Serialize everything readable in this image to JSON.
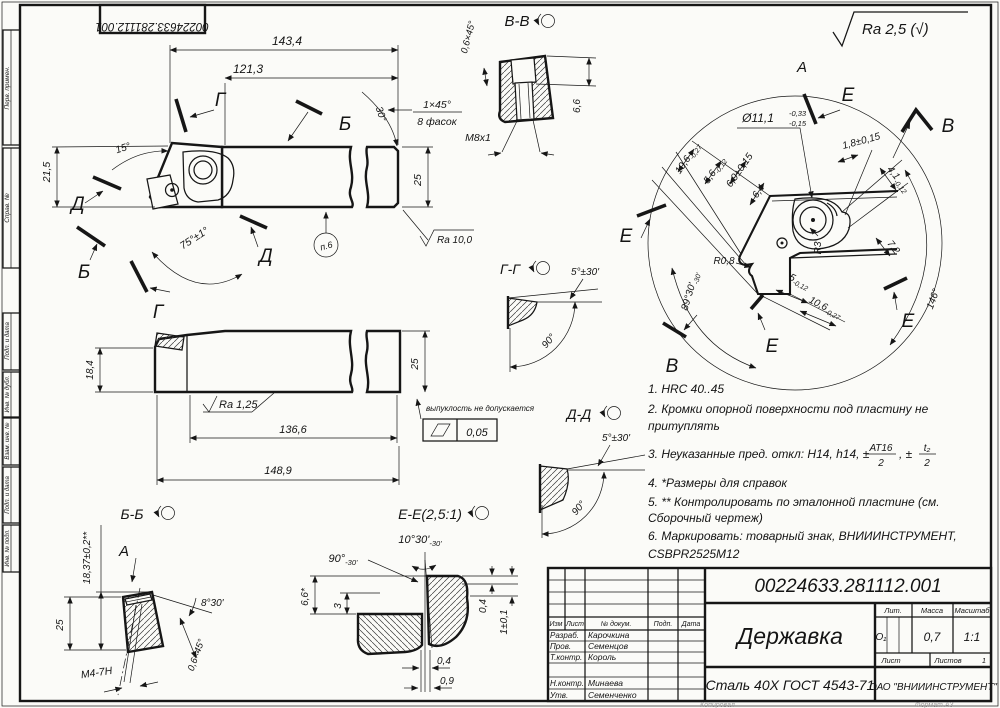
{
  "corner_stamp": "00224633.281112.001",
  "margin": [
    "Перв. примен.",
    "Справ. №",
    "Подп. и дата",
    "Инв. № дубл.",
    "Взам. инв. №",
    "Подп. и дата",
    "Инв. № подл."
  ],
  "general_roughness": "Ra 2,5 (√)",
  "top_view": {
    "label_g": "Г",
    "label_b": "Б",
    "label_d": "Д",
    "dim_total": "143,4",
    "dim_shank": "121,3",
    "angle_head": "15°",
    "dim_height_head": "21,5",
    "angle_main": "75°±1°",
    "angle_tip": "30°",
    "chamfer": "1×45°",
    "chamfer_count": "8 фасок",
    "dim_height": "25",
    "roughness": "Ra 10,0",
    "note_ref": "п.6"
  },
  "section_vv": {
    "title": "В-В",
    "chamfer": "0,6×45°",
    "depth": "6,6",
    "thread": "М8х1"
  },
  "detail_a": {
    "label": "А",
    "dia": {
      "main": "Ø11,1",
      "up": "-0,33",
      "low": "-0,15"
    },
    "dims_left": [
      {
        "v": "10,6",
        "t": "-0,27"
      },
      {
        "v": "5,6",
        "t": "-0,12"
      },
      {
        "v": "6,9±0,15",
        "t": ""
      },
      {
        "v": "6,4",
        "t": ""
      }
    ],
    "dims_right": [
      {
        "v": "1,8±0,15",
        "t": ""
      },
      {
        "v": "4,1",
        "t": "-0,12"
      },
      {
        "v": "7,2",
        "t": ""
      }
    ],
    "dims_bottom": [
      {
        "v": "5",
        "t": "-0,12"
      },
      {
        "v": "10,6",
        "t": "-0,27"
      }
    ],
    "radius1": "R0,8",
    "radius2": "R3",
    "angle1": "89°30'",
    "angle1t": "-30'",
    "angle2": "146°",
    "label_e": "Е",
    "label_v": "В"
  },
  "notes": {
    "n1": "1. HRC 40..45",
    "n2a": "2. Кромки опорной поверхности под пластину  не",
    "n2b": "притуплять",
    "n3a": "3. Неуказанные пред. откл: Н14, h14, ±",
    "n3f1n": "АТ16",
    "n3f1d": "2",
    "n3mid": ", ±",
    "n3f2n": "t₂",
    "n3f2d": "2",
    "n4": "4.  *Размеры для справок",
    "n5a": "5.  ** Контролировать по эталонной пластине (см.",
    "n5b": "Сборочный чертеж)",
    "n6a": "6.   Маркировать: товарный знак, ВНИИИНСТРУМЕНТ,",
    "n6b": "CSBPR2525M12"
  },
  "front_view": {
    "dim_h1": "18,4",
    "roughness": "Ra 1,25",
    "dim_l1": "136,6",
    "dim_l2": "148,9",
    "dim_h2": "25",
    "flat_note": "выпуклость не допускается",
    "flat_tol": "0,05"
  },
  "section_gg": {
    "title": "Г-Г",
    "angle1": "5°±30'",
    "angle2": "90°"
  },
  "section_dd": {
    "title": "Д-Д",
    "angle1": "5°±30'",
    "angle2": "90°"
  },
  "section_bb": {
    "title": "Б-Б",
    "label_a": "А",
    "dim_h": "18,37±0,2**",
    "dim_h2": "25",
    "thread": "М4-7Н",
    "angle": "8°30'",
    "chamfer": "0,6×45°"
  },
  "section_ee": {
    "title": "Е-Е(2,5:1)",
    "angle1": "10°30'",
    "angle1t": "-30'",
    "angle2": "90°",
    "angle2t": "-30'",
    "dim1": "6,6*",
    "dim2": "3",
    "dim3": "0,4",
    "dim4": "1±0,1",
    "dim5": "0,4",
    "dim6": "0,9"
  },
  "title_block": {
    "doc_number": "00224633.281112.001",
    "name": "Державка",
    "material": "Сталь 40Х ГОСТ 4543-71",
    "company": "ОАО \"ВНИИИНСТРУМЕНТ\"",
    "header": {
      "izm": "Изм",
      "list": "Лист",
      "doc": "№ докум.",
      "podp": "Подп.",
      "data": "Дата"
    },
    "rows": [
      {
        "role": "Разраб.",
        "name": "Карочкина"
      },
      {
        "role": "Пров.",
        "name": "Семенцов"
      },
      {
        "role": "Т.контр.",
        "name": "Король"
      },
      {
        "role": "Н.контр.",
        "name": "Минаева"
      },
      {
        "role": "Утв.",
        "name": "Семенченко"
      }
    ],
    "lit_label": "Лит.",
    "mass_label": "Масса",
    "scale_label": "Масштаб",
    "lit": "О₁",
    "mass": "0,7",
    "scale": "1:1",
    "sheet_label": "Лист",
    "sheets_label": "Листов",
    "sheets": "1"
  },
  "footer": {
    "copy": "Копировал",
    "format": "Формат А3"
  }
}
